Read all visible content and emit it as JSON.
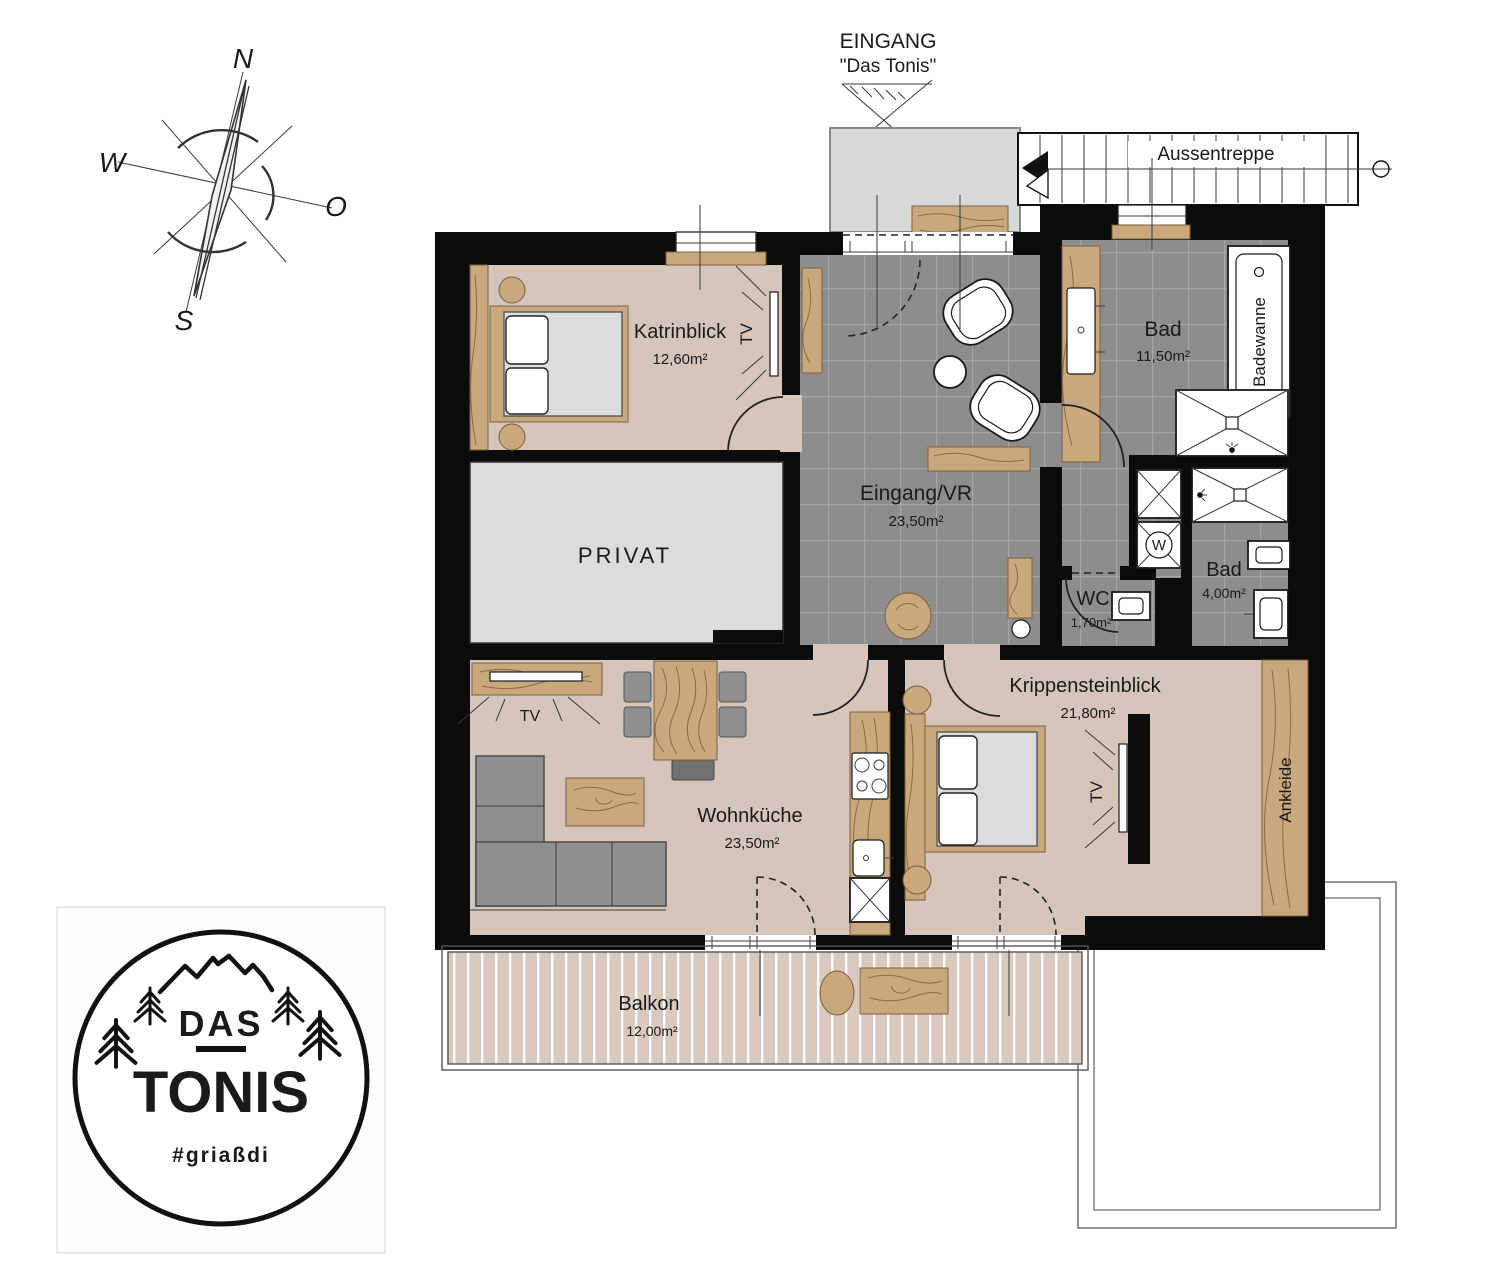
{
  "compass": {
    "north": "N",
    "west": "W",
    "east": "O",
    "south": "S"
  },
  "entrance": {
    "title": "EINGANG",
    "subtitle": "\"Das Tonis\""
  },
  "staircase": {
    "label": "Aussentreppe"
  },
  "rooms": {
    "katrinblick": {
      "name": "Katrinblick",
      "area": "12,60m²"
    },
    "privat": {
      "name": "PRIVAT"
    },
    "eingang_vr": {
      "name": "Eingang/VR",
      "area": "23,50m²"
    },
    "bad_gross": {
      "name": "Bad",
      "area": "11,50m²"
    },
    "wc": {
      "name": "WC",
      "area": "1,70m²"
    },
    "bad_klein": {
      "name": "Bad",
      "area": "4,00m²"
    },
    "wohnkueche": {
      "name": "Wohnküche",
      "area": "23,50m²"
    },
    "krippensteinblick": {
      "name": "Krippensteinblick",
      "area": "21,80m²"
    },
    "ankleide": {
      "name": "Ankleide"
    },
    "balkon": {
      "name": "Balkon",
      "area": "12,00m²"
    }
  },
  "fixtures": {
    "bathtub_label": "Badewanne",
    "washing_machine_label": "W",
    "tv_label": "TV"
  },
  "logo": {
    "line1": "DAS",
    "line2": "TONIS",
    "tagline": "#griaßdi"
  },
  "colors": {
    "wall": "#0b0b0b",
    "room_floor": "#d5c5bb",
    "tile_floor": "#8d8d8d",
    "wood": "#c9a87e",
    "privat_floor": "#dcdcdc",
    "balcony_deck": "#d9c9bf",
    "landing": "#d9d9d9"
  }
}
